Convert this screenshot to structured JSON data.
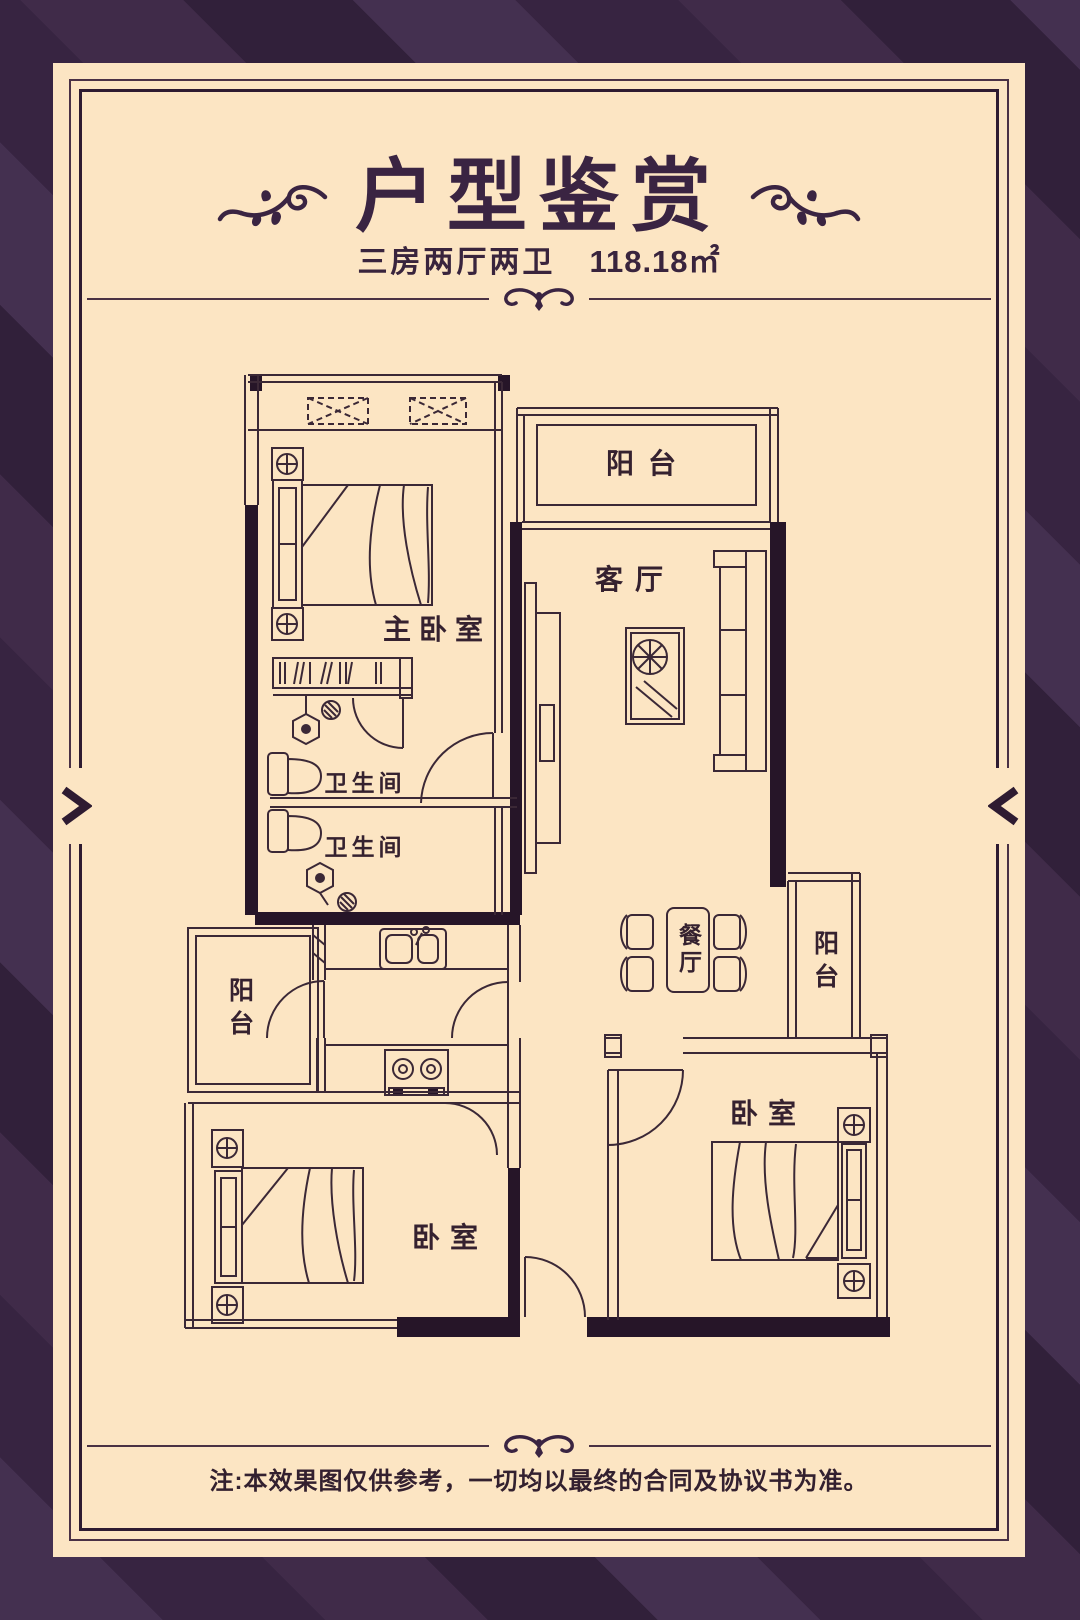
{
  "colors": {
    "background_stripe_light": "#443050",
    "background_stripe_dark": "#31203a",
    "card": "#fce5c3",
    "ink": "#3a2442",
    "plan_line": "#3b2836",
    "plan_wall": "#261528"
  },
  "header": {
    "title": "户型鉴赏",
    "subtitle_layout": "三房两厅两卫",
    "subtitle_area": "118.18㎡"
  },
  "floor_plan": {
    "rooms": [
      {
        "key": "balcony-top",
        "label": "阳台"
      },
      {
        "key": "living-room",
        "label": "客厅"
      },
      {
        "key": "master-bedroom",
        "label": "主卧室"
      },
      {
        "key": "bathroom-upper",
        "label": "卫生间"
      },
      {
        "key": "bathroom-lower",
        "label": "卫生间"
      },
      {
        "key": "balcony-left",
        "label": "阳台"
      },
      {
        "key": "dining-room",
        "label": "餐厅"
      },
      {
        "key": "balcony-right",
        "label": "阳台"
      },
      {
        "key": "bedroom-left",
        "label": "卧室"
      },
      {
        "key": "bedroom-right",
        "label": "卧室"
      }
    ]
  },
  "footer": {
    "disclaimer": "注:本效果图仅供参考，一切均以最终的合同及协议书为准。"
  }
}
